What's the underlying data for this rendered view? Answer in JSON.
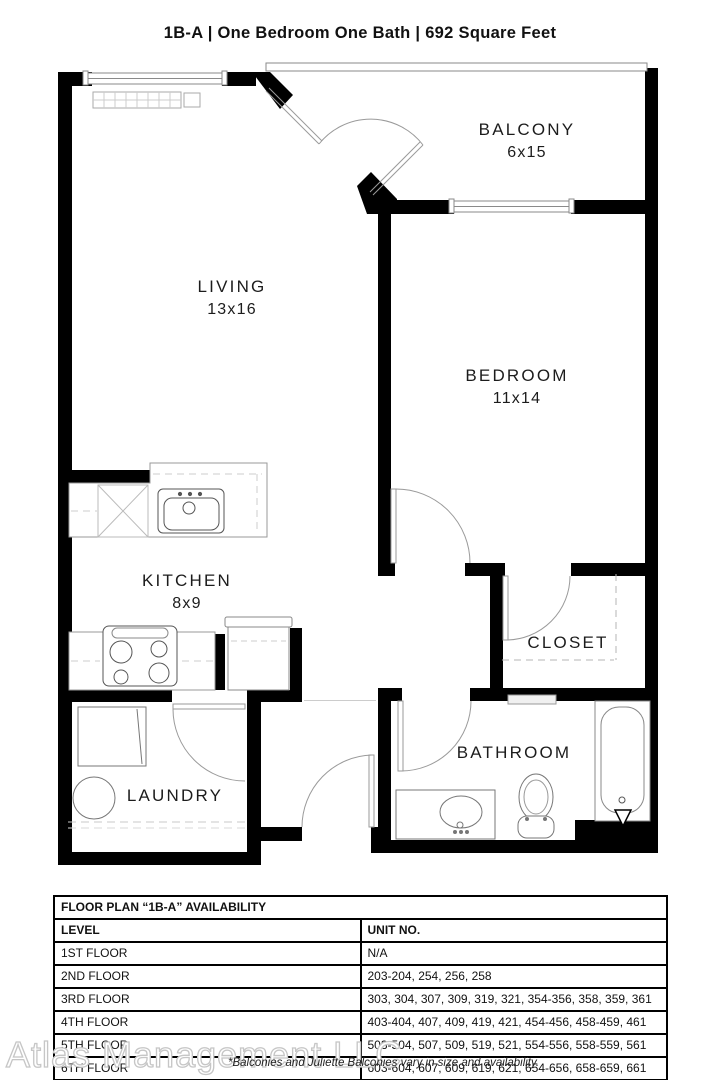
{
  "title": "1B-A | One Bedroom One Bath |  692 Square Feet",
  "rooms": {
    "living": {
      "name": "LIVING",
      "dims": "13x16"
    },
    "balcony": {
      "name": "BALCONY",
      "dims": "6x15"
    },
    "bedroom": {
      "name": "BEDROOM",
      "dims": "11x14"
    },
    "kitchen": {
      "name": "KITCHEN",
      "dims": "8x9"
    },
    "closet": {
      "name": "CLOSET"
    },
    "bathroom": {
      "name": "BATHROOM"
    },
    "laundry": {
      "name": "LAUNDRY"
    }
  },
  "availability": {
    "title": "FLOOR PLAN “1B-A” AVAILABILITY",
    "headers": {
      "level": "LEVEL",
      "unit": "UNIT NO."
    },
    "rows": [
      {
        "level": "1ST FLOOR",
        "units": "N/A"
      },
      {
        "level": "2ND FLOOR",
        "units": "203-204, 254, 256, 258"
      },
      {
        "level": "3RD FLOOR",
        "units": "303, 304, 307, 309, 319, 321, 354-356, 358, 359, 361"
      },
      {
        "level": "4TH FLOOR",
        "units": "403-404, 407, 409, 419, 421, 454-456, 458-459, 461"
      },
      {
        "level": "5TH FLOOR",
        "units": "503-504, 507, 509, 519, 521, 554-556, 558-559, 561"
      },
      {
        "level": "6TH FLOOR",
        "units": "603-604, 607, 609, 619, 621, 654-656, 658-659, 661"
      }
    ]
  },
  "footer": {
    "watermark": "Atlas Management LLC",
    "note": "*Balconies and Juliette Balconies vary in size and availability."
  },
  "colors": {
    "wall": "#000000",
    "fixture_line": "#8a8a8a",
    "watermark_outline": "#c6c6c6"
  }
}
